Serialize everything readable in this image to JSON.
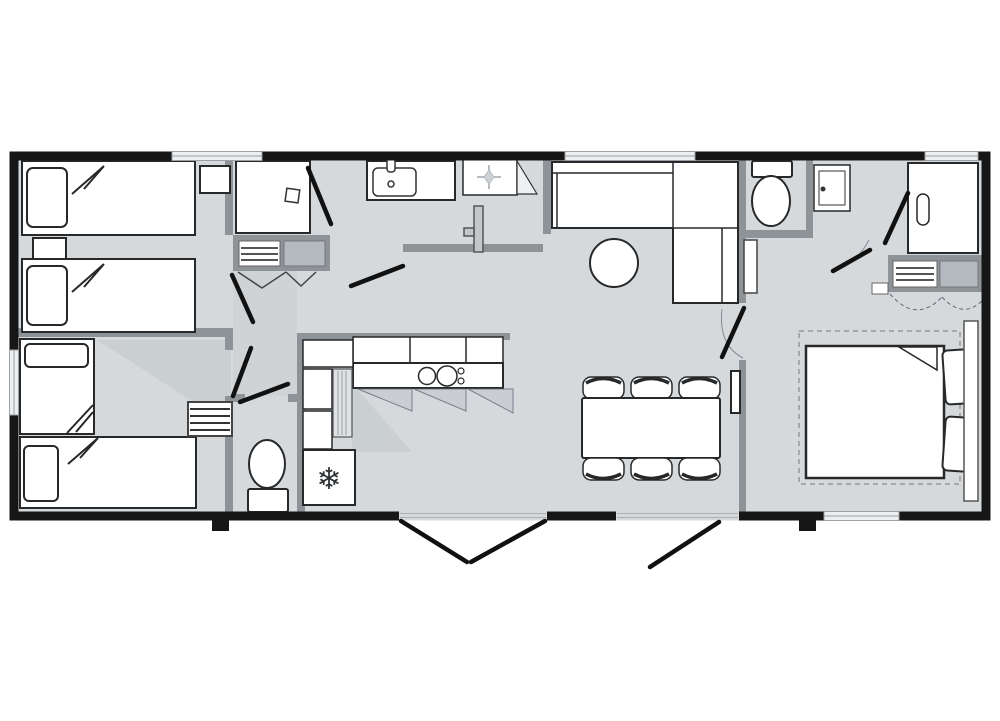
{
  "title": "mobile-home-floor-plan",
  "colors": {
    "floor": "#d6d9dc",
    "outer_wall": "#161616",
    "inner_wall": "#8e9398",
    "furniture_line": "#26282a",
    "closet_fill": "#8e9398",
    "closet_shelf_fill": "#b5bac0",
    "shade": "#c2c7cb",
    "window_fill": "#eceef0",
    "door_leaf": "#111111",
    "light_line": "#b6bcc1"
  },
  "icons": {
    "freezer_snowflake": "❄"
  },
  "rooms": [
    {
      "name": "bedroom-twin-top-left",
      "furniture": [
        "single-bed",
        "single-bed",
        "nightstand",
        "corner-table"
      ]
    },
    {
      "name": "bedroom-twin-bottom-left",
      "furniture": [
        "single-bed-vertical",
        "single-bed-horizontal",
        "ladder-shelf"
      ]
    },
    {
      "name": "shower-room-left",
      "furniture": [
        "shower-enclosure",
        "closet-with-shelves"
      ]
    },
    {
      "name": "bathroom",
      "furniture": [
        "washbasin",
        "shower-tray",
        "pivot-door"
      ]
    },
    {
      "name": "wc-left",
      "furniture": [
        "toilet"
      ]
    },
    {
      "name": "hallway",
      "furniture": []
    },
    {
      "name": "kitchen",
      "furniture": [
        "l-shaped-counter",
        "wall-cabinets",
        "cooktop",
        "tall-unit",
        "fridge-freezer"
      ]
    },
    {
      "name": "living-dining",
      "furniture": [
        "corner-sofa",
        "round-table",
        "dining-table",
        "six-stools",
        "wall-tv"
      ]
    },
    {
      "name": "wc-right",
      "furniture": [
        "toilet",
        "hand-basin"
      ]
    },
    {
      "name": "master-bedroom",
      "furniture": [
        "double-bed",
        "wardrobe",
        "shelf-unit",
        "headboard"
      ]
    }
  ],
  "openings": {
    "windows": 5,
    "exterior_door_sets": 2,
    "interior_door_leaves": 8,
    "entry_steps": 2
  }
}
